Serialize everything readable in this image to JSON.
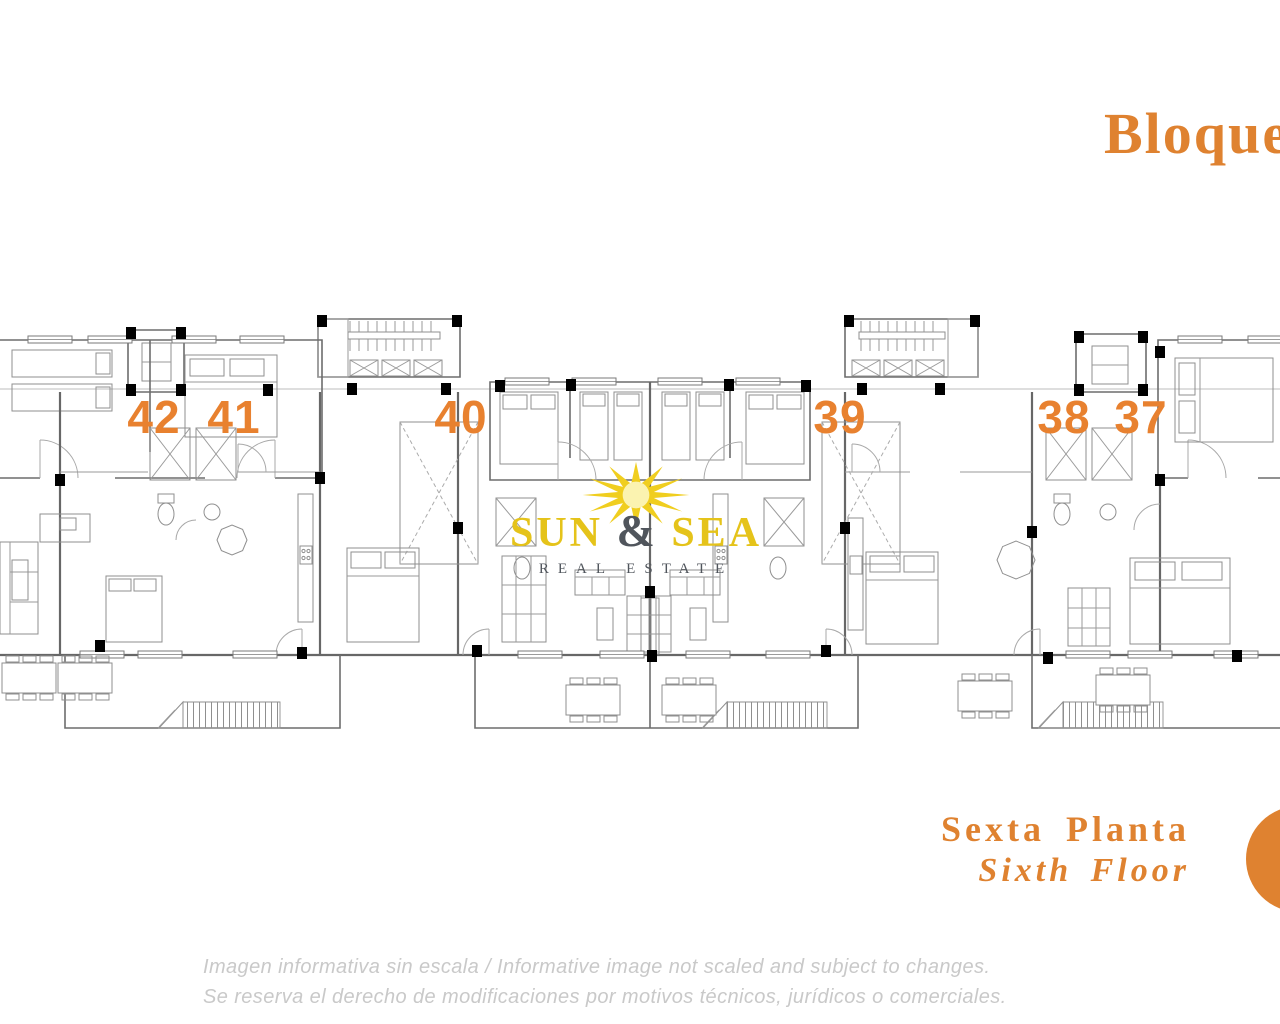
{
  "theme": {
    "accent_orange": "#DF8230",
    "number_orange": "#E8812F",
    "sun_yellow": "#F0CE1F",
    "sun_text_yellow": "#E5C31A",
    "logo_dark_gray": "#50555C",
    "disclaimer_gray": "#C9C9C9",
    "marker_red": "#B43B30",
    "wall_gray": "#6d6d6d"
  },
  "title": {
    "text": "Bloque"
  },
  "plan": {
    "units": [
      {
        "label": "42"
      },
      {
        "label": "41"
      },
      {
        "label": "40"
      },
      {
        "label": "39"
      },
      {
        "label": "38"
      },
      {
        "label": "37"
      }
    ]
  },
  "watermark": {
    "word1": "SUN",
    "amp": "&",
    "word2": "SEA",
    "tagline": "REAL ESTATE",
    "sun_icon": "sunburst-icon"
  },
  "floor_label": {
    "es": "Sexta Planta",
    "en": "Sixth Floor"
  },
  "disclaimer": {
    "line1": "Imagen informativa sin escala /  Informative image not scaled and subject to changes.",
    "line2": "Se reserva el derecho de modificaciones por motivos técnicos, jurídicos o comerciales."
  }
}
